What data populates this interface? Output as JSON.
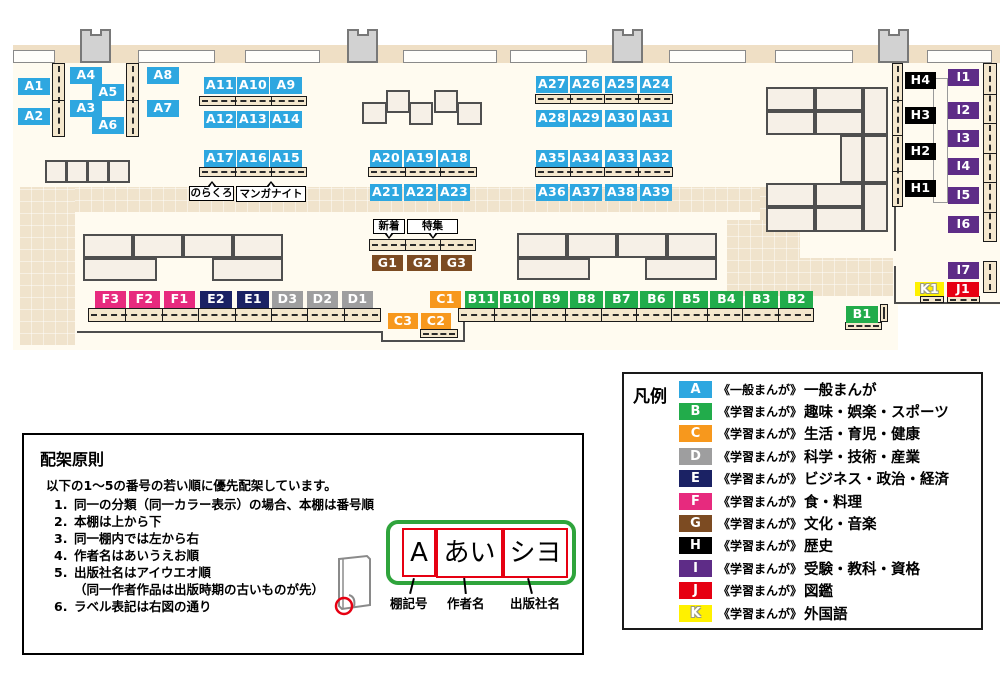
{
  "palette": {
    "floor": "#FFFBF0",
    "carpet": "#F0E3CC",
    "band": "#EFDFC5",
    "shelf": "#F4E7CD",
    "table": "#F6F0E7"
  },
  "categories": {
    "A": {
      "color": "#2EA7E0"
    },
    "B": {
      "color": "#22AC4B"
    },
    "C": {
      "color": "#F7981D"
    },
    "D": {
      "color": "#9E9E9F"
    },
    "E": {
      "color": "#1B2264"
    },
    "F": {
      "color": "#E72A7E"
    },
    "G": {
      "color": "#7C4B22"
    },
    "H": {
      "color": "#000000"
    },
    "I": {
      "color": "#5E2C87"
    },
    "J": {
      "color": "#E60012"
    },
    "K": {
      "color": "#FFF100",
      "outlined_text": true
    }
  },
  "map": {
    "labels": [
      {
        "code": "A1",
        "x": 18,
        "y": 78
      },
      {
        "code": "A2",
        "x": 18,
        "y": 108
      },
      {
        "code": "A4",
        "x": 70,
        "y": 67
      },
      {
        "code": "A5",
        "x": 92,
        "y": 84
      },
      {
        "code": "A3",
        "x": 70,
        "y": 100
      },
      {
        "code": "A6",
        "x": 92,
        "y": 117
      },
      {
        "code": "A8",
        "x": 147,
        "y": 67
      },
      {
        "code": "A7",
        "x": 147,
        "y": 100
      },
      {
        "code": "A11",
        "x": 204,
        "y": 77
      },
      {
        "code": "A10",
        "x": 237,
        "y": 77
      },
      {
        "code": "A9",
        "x": 270,
        "y": 77
      },
      {
        "code": "A12",
        "x": 204,
        "y": 111
      },
      {
        "code": "A13",
        "x": 237,
        "y": 111
      },
      {
        "code": "A14",
        "x": 270,
        "y": 111
      },
      {
        "code": "A17",
        "x": 204,
        "y": 150
      },
      {
        "code": "A16",
        "x": 237,
        "y": 150
      },
      {
        "code": "A15",
        "x": 270,
        "y": 150
      },
      {
        "code": "A20",
        "x": 370,
        "y": 150
      },
      {
        "code": "A19",
        "x": 404,
        "y": 150
      },
      {
        "code": "A18",
        "x": 438,
        "y": 150
      },
      {
        "code": "A21",
        "x": 370,
        "y": 184
      },
      {
        "code": "A22",
        "x": 404,
        "y": 184
      },
      {
        "code": "A23",
        "x": 438,
        "y": 184
      },
      {
        "code": "A27",
        "x": 536,
        "y": 76
      },
      {
        "code": "A26",
        "x": 570,
        "y": 76
      },
      {
        "code": "A25",
        "x": 605,
        "y": 76
      },
      {
        "code": "A24",
        "x": 640,
        "y": 76
      },
      {
        "code": "A28",
        "x": 536,
        "y": 110
      },
      {
        "code": "A29",
        "x": 570,
        "y": 110
      },
      {
        "code": "A30",
        "x": 605,
        "y": 110
      },
      {
        "code": "A31",
        "x": 640,
        "y": 110
      },
      {
        "code": "A35",
        "x": 536,
        "y": 150
      },
      {
        "code": "A34",
        "x": 570,
        "y": 150
      },
      {
        "code": "A33",
        "x": 605,
        "y": 150
      },
      {
        "code": "A32",
        "x": 640,
        "y": 150
      },
      {
        "code": "A36",
        "x": 536,
        "y": 184
      },
      {
        "code": "A37",
        "x": 570,
        "y": 184
      },
      {
        "code": "A38",
        "x": 605,
        "y": 184
      },
      {
        "code": "A39",
        "x": 640,
        "y": 184
      },
      {
        "code": "G1",
        "x": 372,
        "y": 255,
        "w": 31,
        "h": 16
      },
      {
        "code": "G2",
        "x": 407,
        "y": 255,
        "w": 31,
        "h": 16
      },
      {
        "code": "G3",
        "x": 441,
        "y": 255,
        "w": 31,
        "h": 16
      },
      {
        "code": "F3",
        "x": 95,
        "y": 291,
        "w": 31
      },
      {
        "code": "F2",
        "x": 129,
        "y": 291,
        "w": 31
      },
      {
        "code": "F1",
        "x": 164,
        "y": 291,
        "w": 31
      },
      {
        "code": "E2",
        "x": 200,
        "y": 291
      },
      {
        "code": "E1",
        "x": 237,
        "y": 291
      },
      {
        "code": "D3",
        "x": 272,
        "y": 291,
        "w": 31
      },
      {
        "code": "D2",
        "x": 307,
        "y": 291,
        "w": 31
      },
      {
        "code": "D1",
        "x": 342,
        "y": 291,
        "w": 31
      },
      {
        "code": "C1",
        "x": 430,
        "y": 291,
        "w": 31
      },
      {
        "code": "B11",
        "x": 465,
        "y": 291,
        "w": 33
      },
      {
        "code": "B10",
        "x": 500,
        "y": 291,
        "w": 33
      },
      {
        "code": "B9",
        "x": 535,
        "y": 291,
        "w": 33
      },
      {
        "code": "B8",
        "x": 570,
        "y": 291,
        "w": 33
      },
      {
        "code": "B7",
        "x": 605,
        "y": 291,
        "w": 33
      },
      {
        "code": "B6",
        "x": 640,
        "y": 291,
        "w": 33
      },
      {
        "code": "B5",
        "x": 675,
        "y": 291,
        "w": 33
      },
      {
        "code": "B4",
        "x": 710,
        "y": 291,
        "w": 33
      },
      {
        "code": "B3",
        "x": 745,
        "y": 291,
        "w": 33
      },
      {
        "code": "B2",
        "x": 780,
        "y": 291,
        "w": 33
      },
      {
        "code": "C3",
        "x": 388,
        "y": 313,
        "w": 30,
        "h": 16
      },
      {
        "code": "C2",
        "x": 421,
        "y": 313,
        "w": 30,
        "h": 16
      },
      {
        "code": "B1",
        "x": 846,
        "y": 306
      },
      {
        "code": "K1",
        "x": 915,
        "y": 282,
        "w": 29,
        "h": 14
      },
      {
        "code": "J1",
        "x": 947,
        "y": 282,
        "w": 32,
        "h": 15
      },
      {
        "code": "H4",
        "x": 905,
        "y": 72,
        "w": 31
      },
      {
        "code": "H3",
        "x": 905,
        "y": 107,
        "w": 31
      },
      {
        "code": "H2",
        "x": 905,
        "y": 143,
        "w": 31
      },
      {
        "code": "H1",
        "x": 905,
        "y": 180,
        "w": 31
      },
      {
        "code": "I1",
        "x": 948,
        "y": 69,
        "w": 31
      },
      {
        "code": "I2",
        "x": 948,
        "y": 102,
        "w": 31
      },
      {
        "code": "I3",
        "x": 948,
        "y": 130,
        "w": 31
      },
      {
        "code": "I4",
        "x": 948,
        "y": 158,
        "w": 31
      },
      {
        "code": "I5",
        "x": 948,
        "y": 187,
        "w": 31
      },
      {
        "code": "I6",
        "x": 948,
        "y": 216,
        "w": 31
      },
      {
        "code": "I7",
        "x": 948,
        "y": 262,
        "w": 31
      }
    ],
    "notes": [
      {
        "text": "のらくろ",
        "x": 189,
        "y": 186,
        "w": 45,
        "h": 15,
        "tail": "up"
      },
      {
        "text": "マンガナイト",
        "x": 236,
        "y": 186,
        "w": 70,
        "h": 16,
        "tail": "up"
      },
      {
        "text": "新着",
        "x": 373,
        "y": 219,
        "w": 32,
        "h": 15,
        "tail": "down"
      },
      {
        "text": "特集",
        "x": 407,
        "y": 219,
        "w": 51,
        "h": 15,
        "tail": "down"
      }
    ],
    "furniture": {
      "floor": {
        "x": 13,
        "y": 58,
        "w": 987,
        "h": 292
      },
      "band": {
        "x": 13,
        "y": 45,
        "w": 987,
        "h": 18
      },
      "masks": [
        {
          "x": 898,
          "y": 305,
          "w": 102,
          "h": 46
        }
      ],
      "carpets": [
        {
          "x": 20,
          "y": 187,
          "w": 780,
          "h": 25
        },
        {
          "x": 20,
          "y": 187,
          "w": 55,
          "h": 158
        },
        {
          "x": 760,
          "y": 187,
          "w": 40,
          "h": 45
        },
        {
          "x": 727,
          "y": 220,
          "w": 73,
          "h": 76
        },
        {
          "x": 727,
          "y": 258,
          "w": 166,
          "h": 38
        }
      ],
      "windows": [
        {
          "x": 13,
          "y": 50,
          "w": 42,
          "h": 13
        },
        {
          "x": 138,
          "y": 50,
          "w": 77,
          "h": 13
        },
        {
          "x": 245,
          "y": 50,
          "w": 75,
          "h": 13
        },
        {
          "x": 403,
          "y": 50,
          "w": 94,
          "h": 13
        },
        {
          "x": 510,
          "y": 50,
          "w": 77,
          "h": 13
        },
        {
          "x": 669,
          "y": 50,
          "w": 77,
          "h": 13
        },
        {
          "x": 775,
          "y": 50,
          "w": 78,
          "h": 13
        },
        {
          "x": 927,
          "y": 50,
          "w": 65,
          "h": 13
        }
      ],
      "pillars": [
        {
          "x": 80,
          "y": 29,
          "w": 31,
          "h": 34
        },
        {
          "x": 347,
          "y": 29,
          "w": 31,
          "h": 34
        },
        {
          "x": 612,
          "y": 29,
          "w": 31,
          "h": 34
        },
        {
          "x": 878,
          "y": 29,
          "w": 31,
          "h": 34
        }
      ],
      "walls": [
        {
          "x": 894,
          "y": 63,
          "w": 2,
          "h": 188
        },
        {
          "x": 894,
          "y": 266,
          "w": 2,
          "h": 38
        },
        {
          "x": 896,
          "y": 302,
          "w": 104,
          "h": 2
        },
        {
          "x": 77,
          "y": 331,
          "w": 306,
          "h": 2
        },
        {
          "x": 381,
          "y": 331,
          "w": 2,
          "h": 11
        },
        {
          "x": 381,
          "y": 340,
          "w": 84,
          "h": 2
        },
        {
          "x": 463,
          "y": 309,
          "w": 2,
          "h": 33
        }
      ],
      "tables": [
        {
          "x": 45,
          "y": 160,
          "w": 22,
          "h": 23
        },
        {
          "x": 66,
          "y": 160,
          "w": 22,
          "h": 23
        },
        {
          "x": 87,
          "y": 160,
          "w": 22,
          "h": 23
        },
        {
          "x": 108,
          "y": 160,
          "w": 22,
          "h": 23
        },
        {
          "x": 83,
          "y": 234,
          "w": 50,
          "h": 24
        },
        {
          "x": 133,
          "y": 234,
          "w": 50,
          "h": 24
        },
        {
          "x": 183,
          "y": 234,
          "w": 50,
          "h": 24
        },
        {
          "x": 233,
          "y": 234,
          "w": 50,
          "h": 24
        },
        {
          "x": 83,
          "y": 258,
          "w": 74,
          "h": 23
        },
        {
          "x": 212,
          "y": 258,
          "w": 71,
          "h": 23
        },
        {
          "x": 517,
          "y": 233,
          "w": 50,
          "h": 25
        },
        {
          "x": 567,
          "y": 233,
          "w": 50,
          "h": 25
        },
        {
          "x": 617,
          "y": 233,
          "w": 50,
          "h": 25
        },
        {
          "x": 667,
          "y": 233,
          "w": 50,
          "h": 25
        },
        {
          "x": 517,
          "y": 258,
          "w": 73,
          "h": 22
        },
        {
          "x": 645,
          "y": 258,
          "w": 72,
          "h": 22
        },
        {
          "x": 362,
          "y": 102,
          "w": 25,
          "h": 22
        },
        {
          "x": 386,
          "y": 90,
          "w": 24,
          "h": 23
        },
        {
          "x": 409,
          "y": 102,
          "w": 24,
          "h": 23
        },
        {
          "x": 434,
          "y": 90,
          "w": 24,
          "h": 23
        },
        {
          "x": 457,
          "y": 102,
          "w": 25,
          "h": 23
        },
        {
          "x": 766,
          "y": 87,
          "w": 49,
          "h": 24
        },
        {
          "x": 815,
          "y": 87,
          "w": 48,
          "h": 24
        },
        {
          "x": 766,
          "y": 111,
          "w": 49,
          "h": 24
        },
        {
          "x": 815,
          "y": 111,
          "w": 48,
          "h": 24
        },
        {
          "x": 863,
          "y": 87,
          "w": 25,
          "h": 48
        },
        {
          "x": 840,
          "y": 135,
          "w": 23,
          "h": 48
        },
        {
          "x": 863,
          "y": 135,
          "w": 25,
          "h": 48
        },
        {
          "x": 766,
          "y": 183,
          "w": 49,
          "h": 24
        },
        {
          "x": 815,
          "y": 183,
          "w": 48,
          "h": 24
        },
        {
          "x": 766,
          "y": 207,
          "w": 49,
          "h": 25
        },
        {
          "x": 815,
          "y": 207,
          "w": 48,
          "h": 25
        },
        {
          "x": 863,
          "y": 183,
          "w": 25,
          "h": 49
        }
      ],
      "shelves_h": [
        {
          "x": 199,
          "y": 96,
          "w": 108,
          "h": 10,
          "seg": 3
        },
        {
          "x": 199,
          "y": 167,
          "w": 108,
          "h": 10,
          "seg": 3
        },
        {
          "x": 368,
          "y": 167,
          "w": 109,
          "h": 10,
          "seg": 3
        },
        {
          "x": 535,
          "y": 94,
          "w": 138,
          "h": 10,
          "seg": 4
        },
        {
          "x": 535,
          "y": 167,
          "w": 138,
          "h": 10,
          "seg": 4
        },
        {
          "x": 369,
          "y": 239,
          "w": 107,
          "h": 12,
          "seg": 3
        },
        {
          "x": 88,
          "y": 308,
          "w": 293,
          "h": 14,
          "seg": 8
        },
        {
          "x": 458,
          "y": 308,
          "w": 356,
          "h": 14,
          "seg": 10
        },
        {
          "x": 420,
          "y": 329,
          "w": 38,
          "h": 9,
          "seg": 1
        },
        {
          "x": 845,
          "y": 322,
          "w": 37,
          "h": 8,
          "seg": 1
        },
        {
          "x": 920,
          "y": 296,
          "w": 24,
          "h": 7,
          "seg": 1
        },
        {
          "x": 947,
          "y": 296,
          "w": 33,
          "h": 7,
          "seg": 1
        }
      ],
      "shelves_v": [
        {
          "x": 52,
          "y": 63,
          "w": 13,
          "h": 74,
          "seg": 2
        },
        {
          "x": 126,
          "y": 63,
          "w": 13,
          "h": 74,
          "seg": 2
        },
        {
          "x": 892,
          "y": 63,
          "w": 11,
          "h": 144,
          "seg": 4
        },
        {
          "x": 983,
          "y": 63,
          "w": 14,
          "h": 179,
          "seg": 6
        },
        {
          "x": 983,
          "y": 261,
          "w": 14,
          "h": 32,
          "seg": 1
        },
        {
          "x": 880,
          "y": 304,
          "w": 8,
          "h": 18,
          "seg": 1
        }
      ],
      "outlines": [
        {
          "x": 933,
          "y": 78,
          "w": 15,
          "h": 125
        }
      ]
    }
  },
  "legend": {
    "title": "凡例",
    "items": [
      {
        "code": "A",
        "series": "《一般まんが》",
        "label": "一般まんが"
      },
      {
        "code": "B",
        "series": "《学習まんが》",
        "label": "趣味・娯楽・スポーツ"
      },
      {
        "code": "C",
        "series": "《学習まんが》",
        "label": "生活・育児・健康"
      },
      {
        "code": "D",
        "series": "《学習まんが》",
        "label": "科学・技術・産業"
      },
      {
        "code": "E",
        "series": "《学習まんが》",
        "label": "ビジネス・政治・経済"
      },
      {
        "code": "F",
        "series": "《学習まんが》",
        "label": "食・料理"
      },
      {
        "code": "G",
        "series": "《学習まんが》",
        "label": "文化・音楽"
      },
      {
        "code": "H",
        "series": "《学習まんが》",
        "label": "歴史"
      },
      {
        "code": "I",
        "series": "《学習まんが》",
        "label": "受験・教科・資格"
      },
      {
        "code": "J",
        "series": "《学習まんが》",
        "label": "図鑑"
      },
      {
        "code": "K",
        "series": "《学習まんが》",
        "label": "外国語"
      }
    ]
  },
  "principles": {
    "title": "配架原則",
    "intro": "以下の1～5の番号の若い順に優先配架しています。",
    "items": [
      {
        "num": "1.",
        "lines": [
          "同一の分類（同一カラー表示）の場合、本棚は番号順"
        ]
      },
      {
        "num": "2.",
        "lines": [
          "本棚は上から下"
        ]
      },
      {
        "num": "3.",
        "lines": [
          "同一棚内では左から右"
        ]
      },
      {
        "num": "4.",
        "lines": [
          "作者名はあいうえお順"
        ]
      },
      {
        "num": "5.",
        "lines": [
          "出版社名はアイウエオ順",
          "（同一作者作品は出版時期の古いものが先）"
        ]
      },
      {
        "num": "6.",
        "lines": [
          "ラベル表記は右図の通り"
        ]
      }
    ],
    "diagram": {
      "spine_boxes": [
        "A",
        "あい",
        "シヨ"
      ],
      "captions": [
        "棚記号",
        "作者名",
        "出版社名"
      ]
    }
  }
}
